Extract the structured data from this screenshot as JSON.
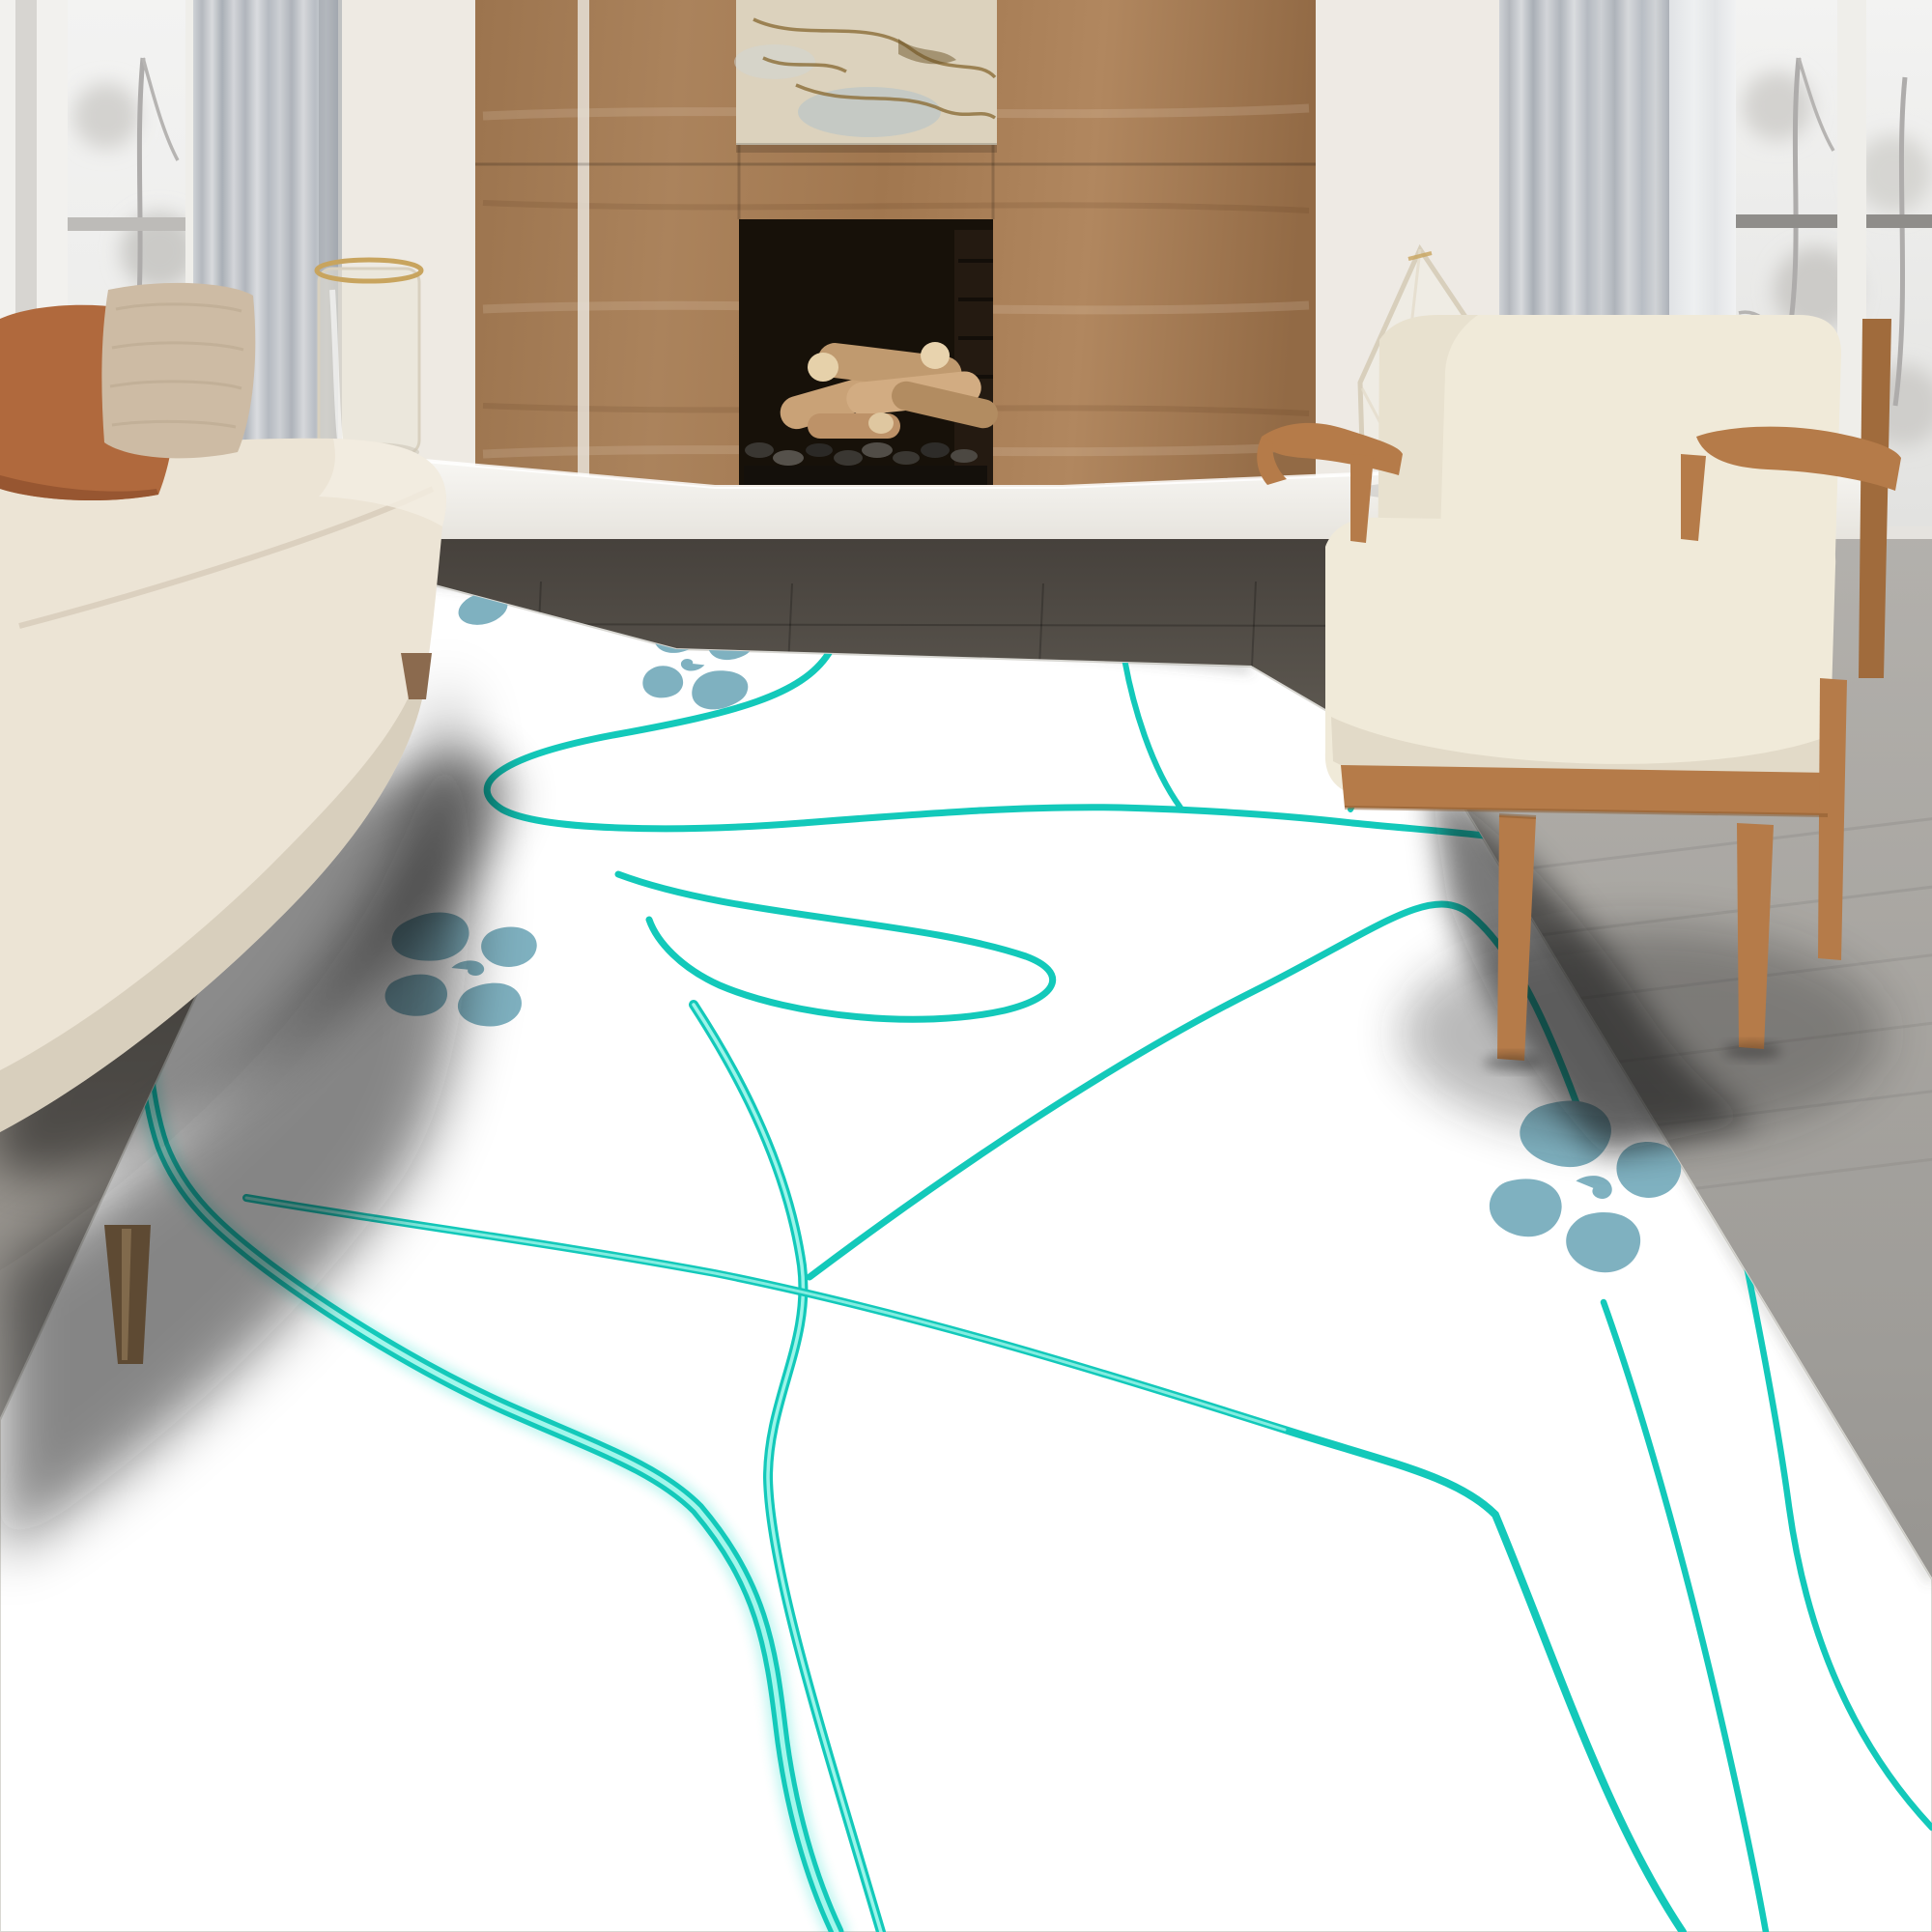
{
  "meta": {
    "title": "Living room product photo of a white 3D-printed floor rug",
    "image_kind": "interior photograph, no visible text"
  },
  "palette": {
    "wall": "#f0ede7",
    "wood_panel": "#a87e58",
    "wood_panel_dark": "#8e6743",
    "firebox": "#171109",
    "log": "#c9a277",
    "log_light": "#e6d1aa",
    "artwork_bg": "#dcd2bd",
    "artwork_vein": "#8f7340",
    "bench": "#f6f4ef",
    "curtain": "#bcc0c5",
    "curtain_sheer": "#dddfe2",
    "window_view": "#ededeb",
    "branch": "#aeacab",
    "floor_dark": "#4e4943",
    "floor_light": "#a9a7a3",
    "rug": "#ffffff",
    "rug_line": "#13c9ba",
    "rug_line_core": "#b4fbf1",
    "paw": "#7fb1c0",
    "sofa": "#ece4d5",
    "sofa_base": "#d6ccba",
    "pillow_rust": "#b0693d",
    "pillow_boucle": "#cdbba4",
    "chair_cushion": "#f0ead9",
    "chair_wood": "#b57b49",
    "glass_rim_gold": "#c8a45e",
    "shadow": "#111110"
  },
  "scene": {
    "room": {
      "left_window": {
        "view": "bare winter trees",
        "curtain": "gray floor-length drape"
      },
      "right_window": {
        "view": "bare winter trees",
        "curtain": "gray drape with white sheer"
      },
      "fireplace": {
        "surround": "walnut wood paneling",
        "artwork_above": "abstract beige painting with map-like veins",
        "firebox_contents": "stacked birch logs on dark pebbles"
      },
      "bench_items": [
        "glass hurricane candle holder",
        "clear faceted diamond sculpture"
      ],
      "floor": "gray wood planks"
    },
    "furniture": {
      "sofa": {
        "position": "left",
        "color_name": "cream",
        "pillow_count": 2
      },
      "armchair": {
        "position": "right",
        "color_name": "cream with wood frame"
      }
    },
    "rug": {
      "style": "white mat with glowing teal squiggle lines and paw prints",
      "paw_print_count": 3,
      "squiggle_line_count": 10
    }
  }
}
